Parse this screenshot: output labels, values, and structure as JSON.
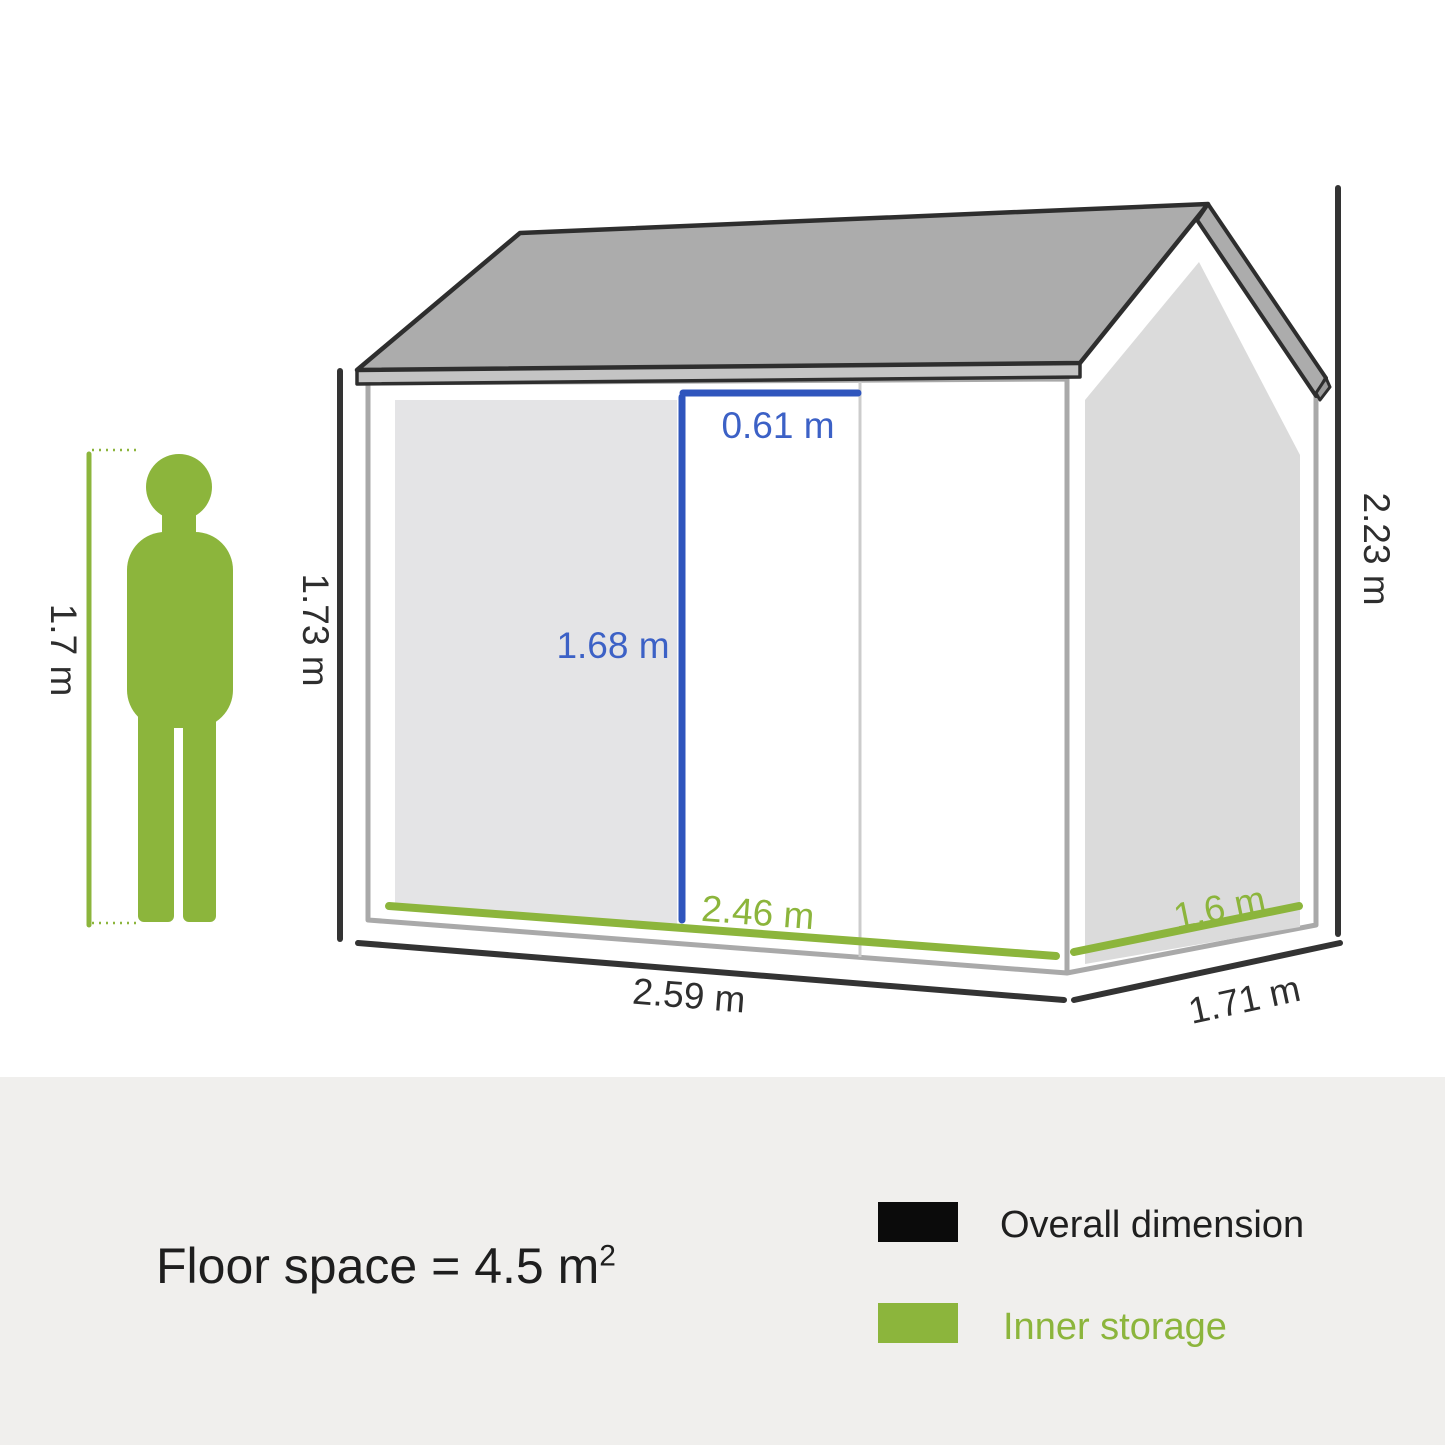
{
  "diagram": {
    "dimensions": {
      "person_height": "1.7 m",
      "front_wall_height": "1.73 m",
      "door_width": "0.61 m",
      "door_height": "1.68 m",
      "inner_width": "2.46 m",
      "inner_depth": "1.6 m",
      "overall_width": "2.59 m",
      "overall_depth": "1.71 m",
      "overall_height": "2.23 m"
    },
    "colors": {
      "overall_dimension_line": "#333333",
      "inner_storage_green": "#8CB53C",
      "door_dimension_blue": "#2F55BD",
      "roof_gray": "#ACACAC",
      "wall_outline_gray": "#A9A9A9",
      "gable_face_gray": "#DBDBDB",
      "door_panel_gray": "#E4E4E6"
    }
  },
  "footer": {
    "floor_space_text": "Floor space = 4.5 m",
    "floor_space_sup": "2",
    "legend": {
      "overall": {
        "label": "Overall dimension",
        "swatch": "#0B0B0B",
        "text_color": "#1F1F1F"
      },
      "inner": {
        "label": "Inner storage",
        "swatch": "#8CB53C",
        "text_color": "#8CB53C"
      }
    }
  }
}
